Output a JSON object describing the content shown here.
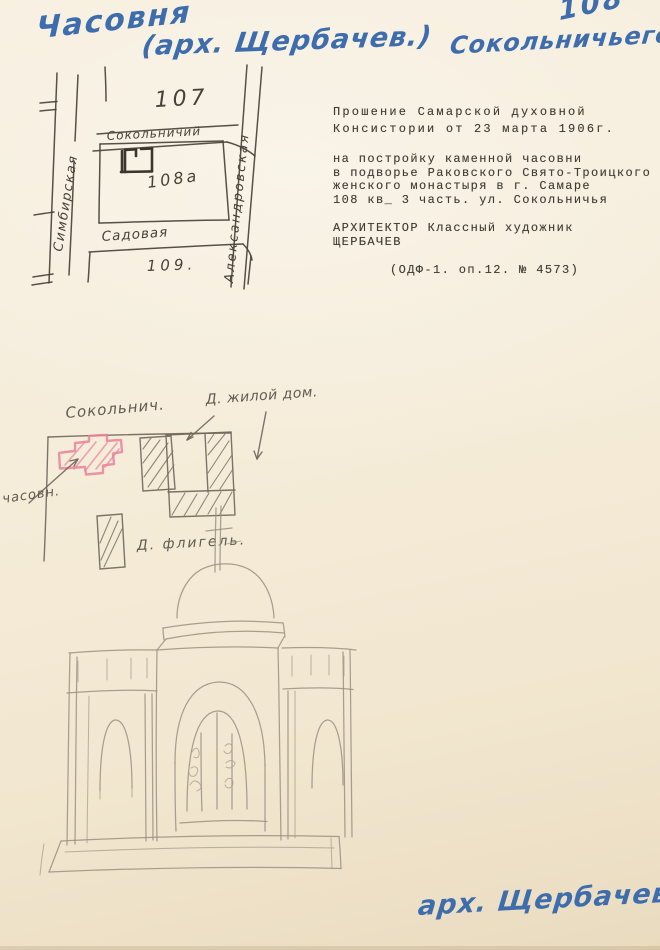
{
  "document": {
    "annotations": {
      "title_word": "Часовня",
      "title_paren": "(арх. Щербачев.)",
      "corner_number": "108",
      "corner_street": "Сокольничьего",
      "signature": "арх. Щербачев."
    },
    "typed_text": {
      "paragraph1": [
        "Прошение Самарской духовной",
        "Консистории от 23 марта 1906г."
      ],
      "paragraph2": [
        "на постройку каменной часовни",
        "в подворье Раковского Свято-Троицкого",
        "женского монастыря в г. Самаре",
        "108 кв_ 3 часть. ул. Сокольничья"
      ],
      "paragraph3": [
        "АРХИТЕКТОР Классный художник",
        "ЩЕРБАЧЕВ"
      ],
      "paragraph4": [
        "(ОДФ-1. оп.12. № 4573)"
      ]
    },
    "ink_map": {
      "block_north": "107",
      "street_north": "Сокольничий",
      "street_west": "Симбирская",
      "street_east": "Александровская",
      "street_south": "Садовая",
      "block_site": "108а",
      "block_south": "109."
    },
    "pencil_plan": {
      "street": "Сокольнич.",
      "dwelling_house": "Д. жилой дом.",
      "chapel": "часовн.",
      "wing": "Д. флигель."
    },
    "colors": {
      "paper": "#f4ecd9",
      "ink_blue": "#3d6dac",
      "ink_dark": "#49423a",
      "pencil_dark": "#6e665b",
      "pencil_light": "#9a9184",
      "chapel_pink": "#e8849b"
    }
  }
}
